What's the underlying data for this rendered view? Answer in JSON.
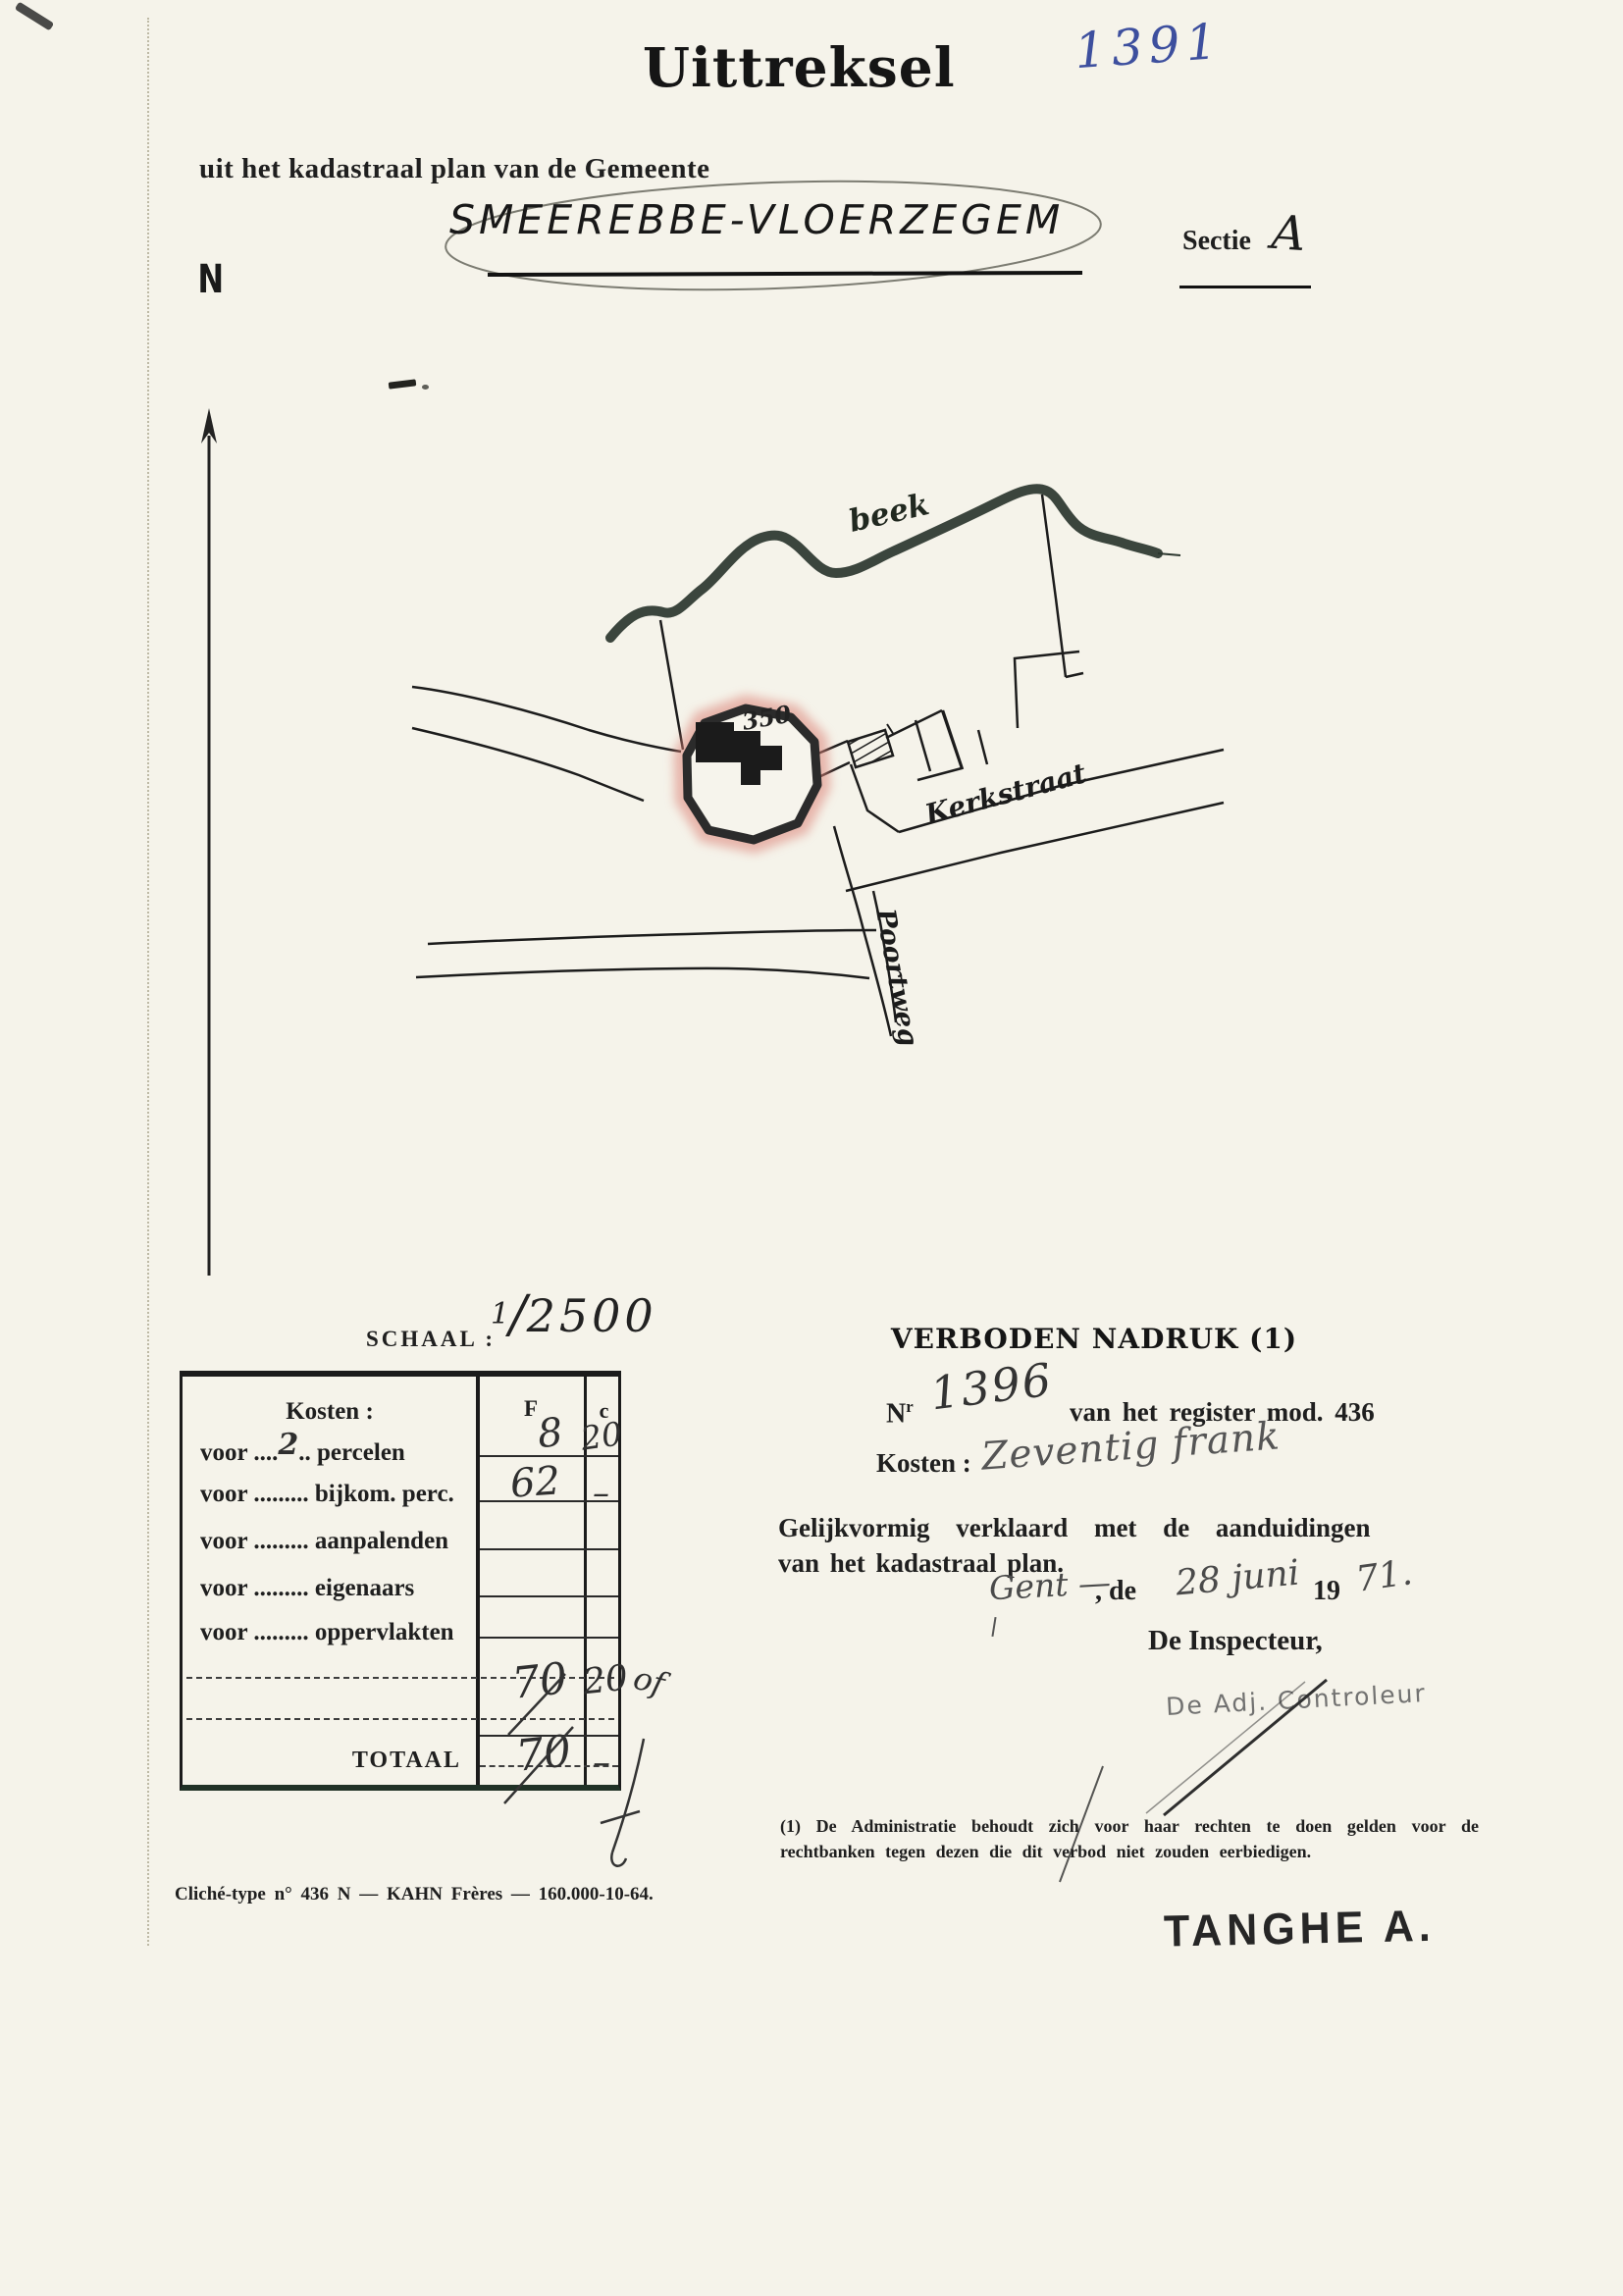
{
  "page": {
    "corner_number": "1391",
    "title": "Uittreksel",
    "subtitle": "uit het kadastraal plan van de Gemeente",
    "municipality": "SMEEREBBE-VLOERZEGEM",
    "sectie_label": "Sectie",
    "sectie_value": "A",
    "north_label": "N"
  },
  "map": {
    "stream_label": "beek",
    "parcel_number": "350",
    "street_kerkstraat": "Kerkstraat",
    "street_poortweg": "Poortweg",
    "highlight_color": "#dc8378"
  },
  "schaal": {
    "label": "SCHAAL :",
    "numerator": "1",
    "slash": "/",
    "denominator": "2500"
  },
  "kosten_table": {
    "header": "Kosten :",
    "col_f": "F",
    "col_c": "c",
    "rows": [
      {
        "pre": "voor ....",
        "hand": "2",
        "post": ".. percelen",
        "f": "8",
        "c": "20"
      },
      {
        "pre": "voor .........",
        "hand": "",
        "post": " bijkom. perc.",
        "f": "62",
        "c": "–"
      },
      {
        "pre": "voor .........",
        "hand": "",
        "post": " aanpalenden",
        "f": "",
        "c": ""
      },
      {
        "pre": "voor .........",
        "hand": "",
        "post": " eigenaars",
        "f": "",
        "c": ""
      },
      {
        "pre": "voor .........",
        "hand": "",
        "post": " oppervlakten",
        "f": "",
        "c": ""
      }
    ],
    "subtotal": {
      "f": "70",
      "c": "20",
      "flourish": "of"
    },
    "total_label": "TOTAAL",
    "total": {
      "f": "70",
      "c": "–"
    }
  },
  "certificate": {
    "verboden": "VERBODEN NADRUK (1)",
    "nr_label": "N",
    "nr_sup": "r",
    "nr_value": "1396",
    "register_text": "van het register mod. 436",
    "kosten_label": "Kosten :",
    "kosten_value": "Zeventig frank",
    "conform_line1": "Gelijkvormig verklaard met de aanduidingen",
    "conform_line2": "van het kadastraal plan.",
    "place_value": "Gent —",
    "date_de": ", de",
    "date_value": "28 juni",
    "year_print": "19",
    "year_value": "71.",
    "inspecteur": "De Inspecteur,",
    "stamp_adjunct": "De Adj. Controleur",
    "footnote": "(1) De Administratie behoudt zich voor haar rechten te doen gelden voor de rechtbanken tegen dezen die dit verbod niet zouden eerbiedigen.",
    "stamp_name": "TANGHE A."
  },
  "footer": {
    "cliche_line": "Cliché-type n° 436 N — KAHN Frères — 160.000-10-64."
  }
}
